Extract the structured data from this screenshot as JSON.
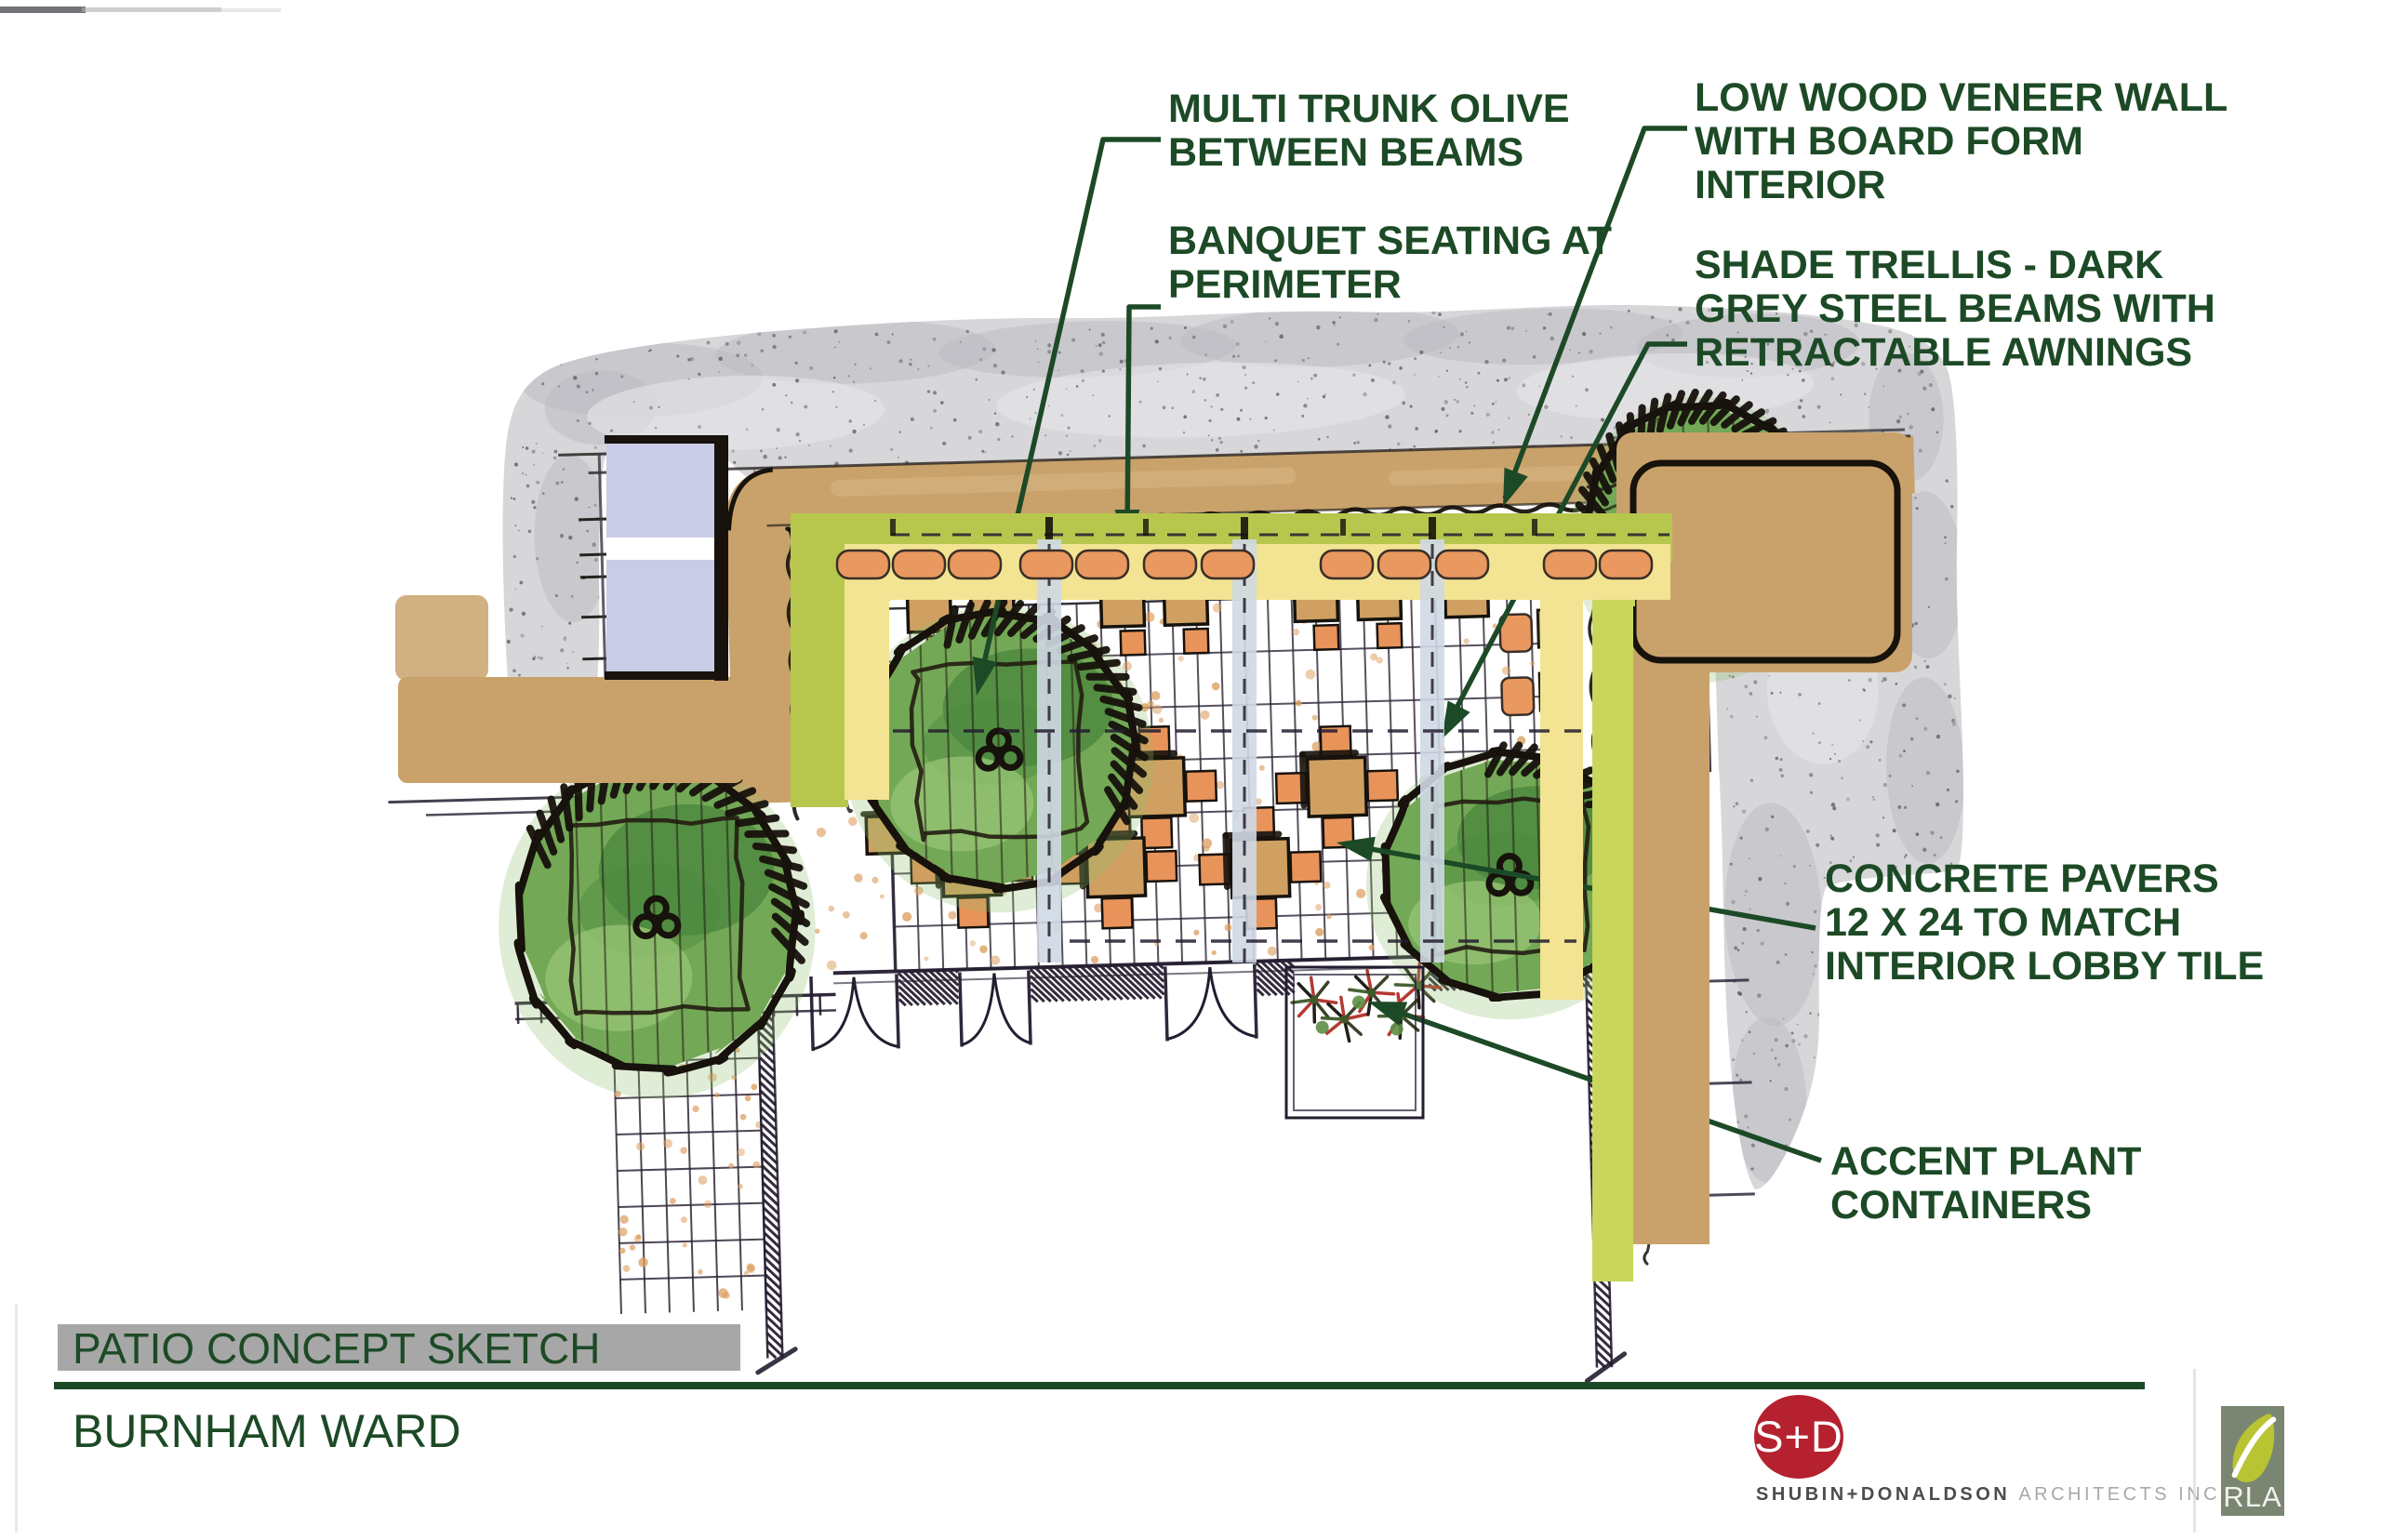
{
  "title_block": {
    "sheet_title": "PATIO CONCEPT SKETCH",
    "project_name": "BURNHAM WARD"
  },
  "annotations": {
    "multi_trunk_olive": {
      "text": "MULTI TRUNK OLIVE\nBETWEEN BEAMS"
    },
    "banquet_seating": {
      "text": "BANQUET SEATING AT\nPERIMETER"
    },
    "low_wood_wall": {
      "text": "LOW WOOD VENEER WALL\nWITH BOARD FORM\nINTERIOR"
    },
    "shade_trellis": {
      "text": "SHADE TRELLIS - DARK\nGREY STEEL BEAMS WITH\nRETRACTABLE AWNINGS"
    },
    "concrete_pavers": {
      "text": "CONCRETE PAVERS\n12 X 24 TO MATCH\nINTERIOR LOBBY TILE"
    },
    "accent_plants": {
      "text": "ACCENT PLANT\nCONTAINERS"
    }
  },
  "logos": {
    "sd_monogram": "S+D",
    "firm_name_primary": "SHUBIN+DONALDSON",
    "firm_name_secondary": "ARCHITECTS INC.",
    "rla_monogram": "RLA"
  },
  "colors": {
    "annotation_green": "#1d4a26",
    "title_bar_gray": "#a7a7a7",
    "concrete_gray": "#d7d7da",
    "speckle_gray": "#66666c",
    "wall_tan": "#c9a26b",
    "wall_tan_light": "#dcba8c",
    "hedge_green": "#b7c74d",
    "hedge_bright": "#c8d65c",
    "banquet_yellow": "#f2e492",
    "cushion_orange": "#e9985f",
    "table_tan": "#cfa062",
    "chair_orange": "#e8935a",
    "ink": "#17120c",
    "grid_ink": "#2e2637",
    "window_lavender": "#c9cce5",
    "tree_green": "#73a956",
    "tree_dark": "#4b873f",
    "tree_light": "#9ac877",
    "accent_red": "#b03028",
    "logo_red": "#b5212e",
    "rla_bg": "#7b8672",
    "rla_leaf": "#b9c433"
  }
}
